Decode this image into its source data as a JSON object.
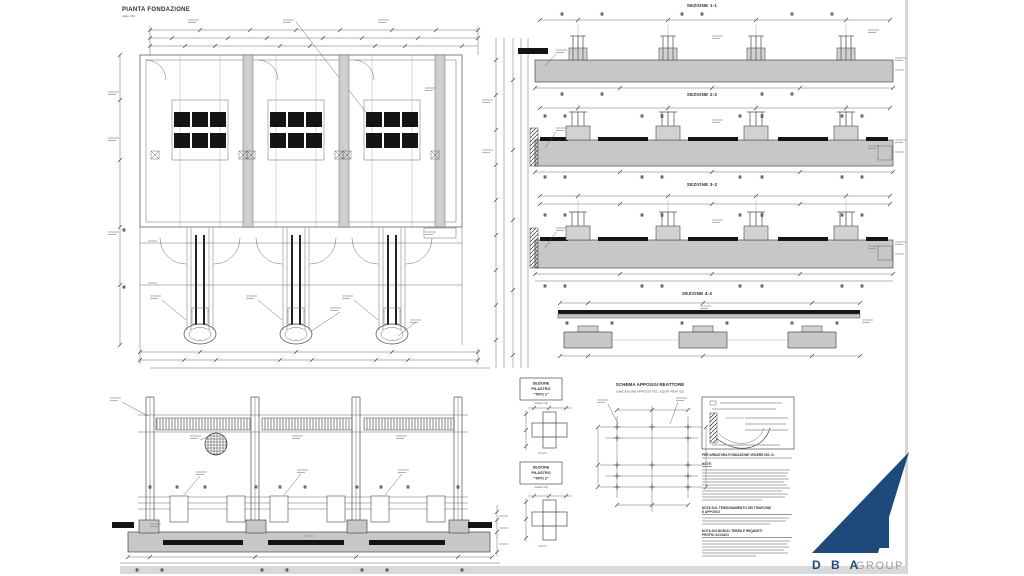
{
  "sheet": {
    "background": "#ffffff",
    "line_color": "#4a4a4a",
    "concrete_fill": "#c7c7c7",
    "rebar_black": "#141414",
    "edge_gray": "#d6d6d6"
  },
  "plan": {
    "title": "PIANTA FONDAZIONE",
    "scale": "scala 1:50"
  },
  "sections": {
    "s1": {
      "title": "SEZIONE 1-1"
    },
    "s2": {
      "title": "SEZIONE 2-2"
    },
    "s3": {
      "title": "SEZIONE 3-3"
    },
    "s4": {
      "title": "SEZIONE 4-4"
    }
  },
  "pilastri": {
    "tipo1": {
      "l1": "SEZIONE",
      "l2": "PILASTRO",
      "l3": "\"TIPO 1\"",
      "scale": "scala 1:20"
    },
    "tipo2": {
      "l1": "SEZIONE",
      "l2": "PILASTRO",
      "l3": "\"TIPO 2\"",
      "scale": "scala 1:20"
    }
  },
  "schema": {
    "title": "SCHEMA APPOGGI REATTORE",
    "subtitle": "(UBICAZIONE APPOGGI TEC. EQUIP. REAT 02)"
  },
  "notes": {
    "ref": "PER ARMATURA FONDAZIONE VEDERE DIS. N.",
    "note_label": "NOTE:",
    "nota1a": "NOTA SUL TENSIONAMENTO DEI TIRAFONDI",
    "nota1b": "E APPOGGI",
    "nota2a": "NOTA SUI MODULI TERRA E REQUISITI",
    "nota2b": "PROFILI ACCIAIO"
  },
  "logo": {
    "dba": "D B A",
    "group": "GROUP",
    "navy": "#1d4a7a",
    "gray": "#9aa0a6"
  }
}
